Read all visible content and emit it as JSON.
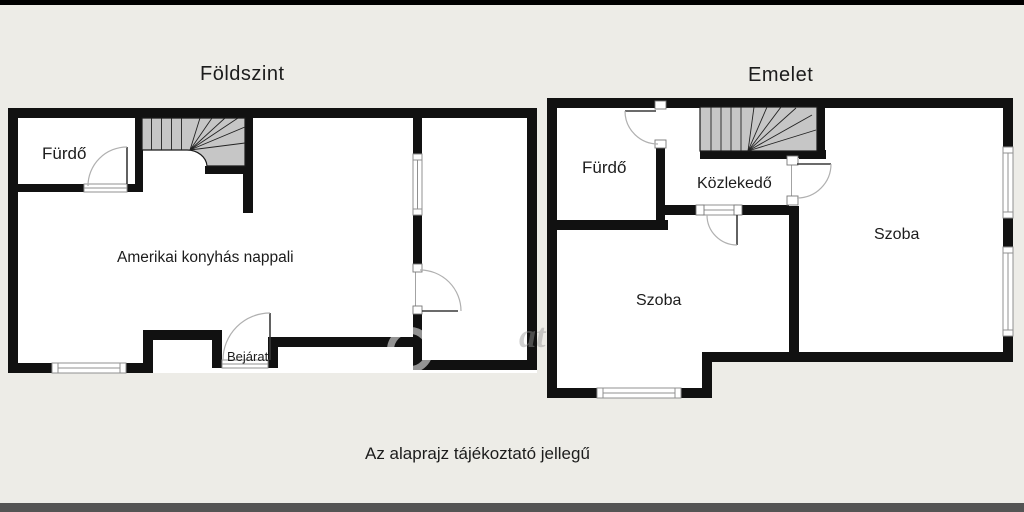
{
  "page": {
    "caption": "Az alaprajz tájékoztató jellegű",
    "background": "#edece7",
    "top_bar_color": "#000000",
    "bottom_bar_color": "#545454"
  },
  "ground_floor": {
    "title": "Földszint",
    "rooms": {
      "bathroom": "Fürdő",
      "living_room": "Amerikai konyhás nappali",
      "entrance": "Bejárat"
    }
  },
  "upper_floor": {
    "title": "Emelet",
    "rooms": {
      "bathroom": "Fürdő",
      "hallway": "Közlekedő",
      "room_small": "Szoba",
      "room_large": "Szoba"
    }
  },
  "watermark": {
    "letters": "at"
  },
  "colors": {
    "wall": "#111111",
    "room_fill": "#ffffff",
    "stairs_fill": "#c6c6c6",
    "stairs_line": "#222222",
    "window_line": "#909090",
    "door_leaf": "#3a3a3a",
    "door_arc": "#b0b0b0",
    "text": "#1c1c1c"
  }
}
